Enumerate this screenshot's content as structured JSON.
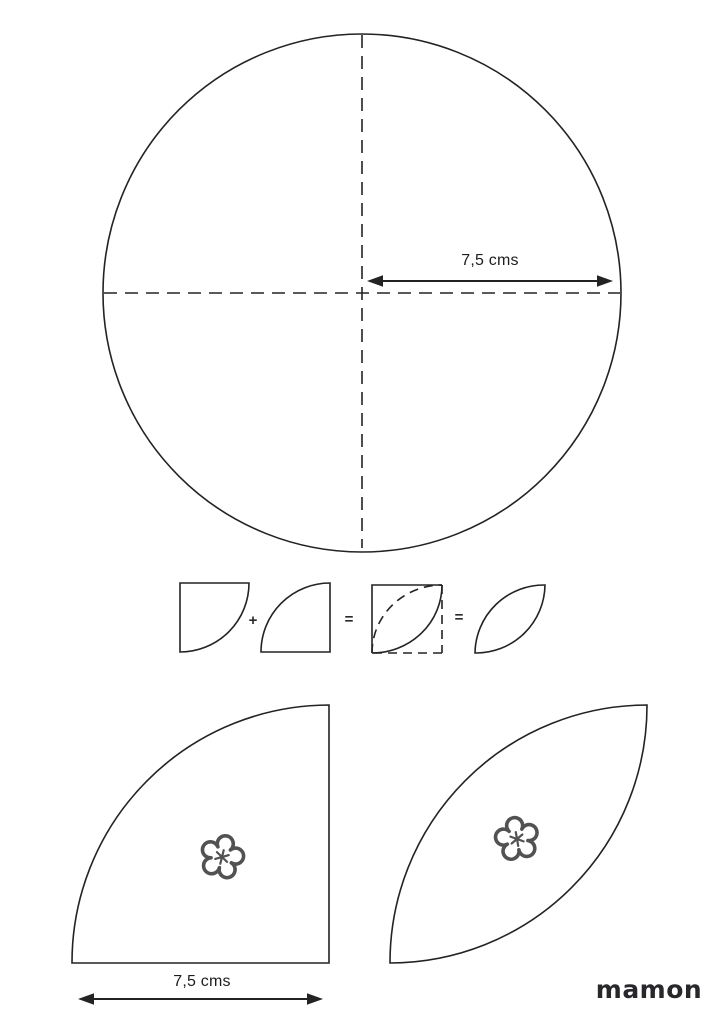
{
  "colors": {
    "background": "#ffffff",
    "line": "#232323",
    "flower_marker": "#525252",
    "logo": "#28282c"
  },
  "circle_diagram": {
    "radius_label": "7,5 cms"
  },
  "assembly_diagram": {
    "plus_operator": "+",
    "equals_operator_1": "=",
    "equals_operator_2": "="
  },
  "templates": {
    "quarter_width_label": "7,5 cms"
  },
  "footer": {
    "logo_text": "mamon"
  },
  "icons": {
    "marker": "flower-asterisk-icon",
    "dimension": "double-arrow-icon"
  }
}
